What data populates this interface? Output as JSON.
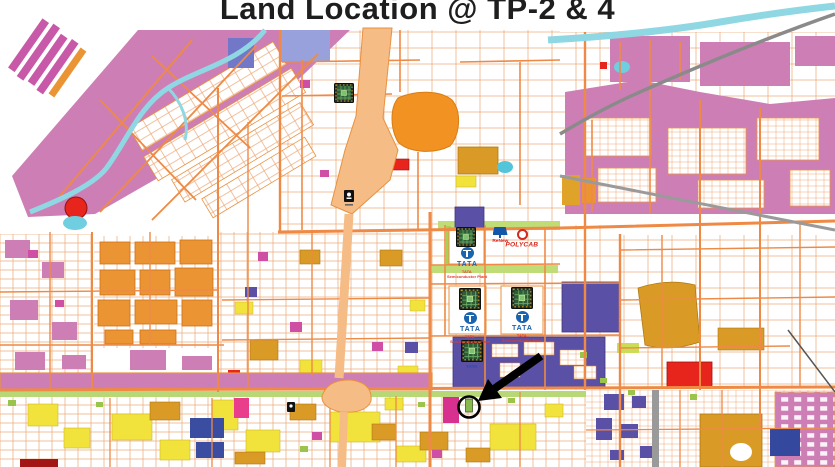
{
  "title": "Land Location @ TP-2 & 4",
  "map": {
    "plants": [
      {
        "wordmark": "TATA",
        "caption_line1": "TATA",
        "caption_line2": "Semiconductor Plant"
      },
      {
        "wordmark": "TATA",
        "caption_line1": "TATA",
        "caption_line2": "Semiconductor Plant"
      },
      {
        "wordmark": "TATA",
        "caption_line1": "TATA",
        "caption_line2": "Semiconductor Plant"
      }
    ],
    "chip_site_caption": "TATA",
    "renew_label": "ReNew",
    "polycab_label": "POLYCAB",
    "icons": {
      "chip": "semiconductor-chip-icon",
      "arrow": "arrow-annotation",
      "target": "target-circle",
      "building": "building-marker-icon",
      "tata": "tata-logo-icon",
      "renew": "solar-panel-icon",
      "polycab": "ring-emblem-icon"
    },
    "colors": {
      "parcel_pink": "#cd7fb5",
      "road_orange": "#ee8a45",
      "expressway_peach": "#f5bd85",
      "water_cyan": "#8fd8e3",
      "zone_purple": "#5a50a5",
      "zone_gold": "#d99a26",
      "zone_yellow": "#f2e23c",
      "zone_red": "#e8251d",
      "zone_blue": "#3b4da0",
      "green_buffer": "#b8d877",
      "tata_blue": "#1a63ad",
      "brand_red": "#d5281e",
      "highway_grey": "#9a9a9a"
    }
  }
}
